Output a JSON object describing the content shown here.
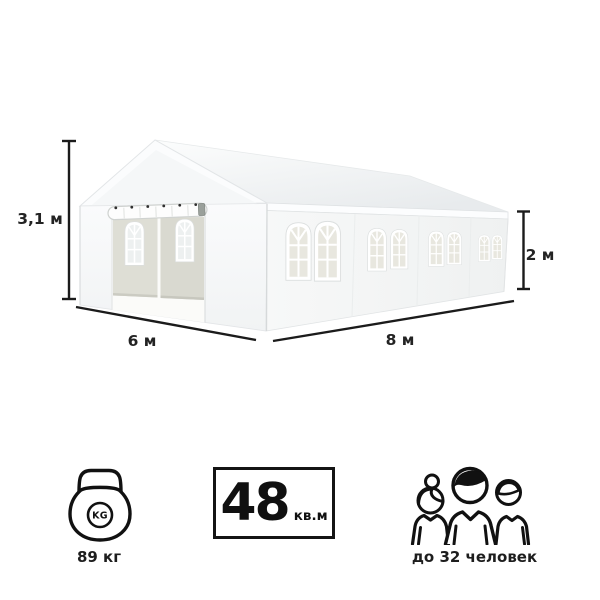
{
  "dimensions": {
    "height": "3,1 м",
    "width": "6 м",
    "length": "8 м",
    "wall_height": "2 м"
  },
  "specs": {
    "weight": {
      "icon": "kettlebell-icon",
      "badge": "KG",
      "label": "89 кг"
    },
    "area": {
      "value": "48",
      "unit": "кв.м"
    },
    "capacity": {
      "icon": "people-icon",
      "label": "до 32 человек"
    }
  },
  "colors": {
    "dimension_line": "#1b1b1b",
    "label_text": "#232323",
    "icon_stroke": "#111111",
    "door_panel": "#dcdcd3",
    "window_glass": "#e8e7df"
  }
}
